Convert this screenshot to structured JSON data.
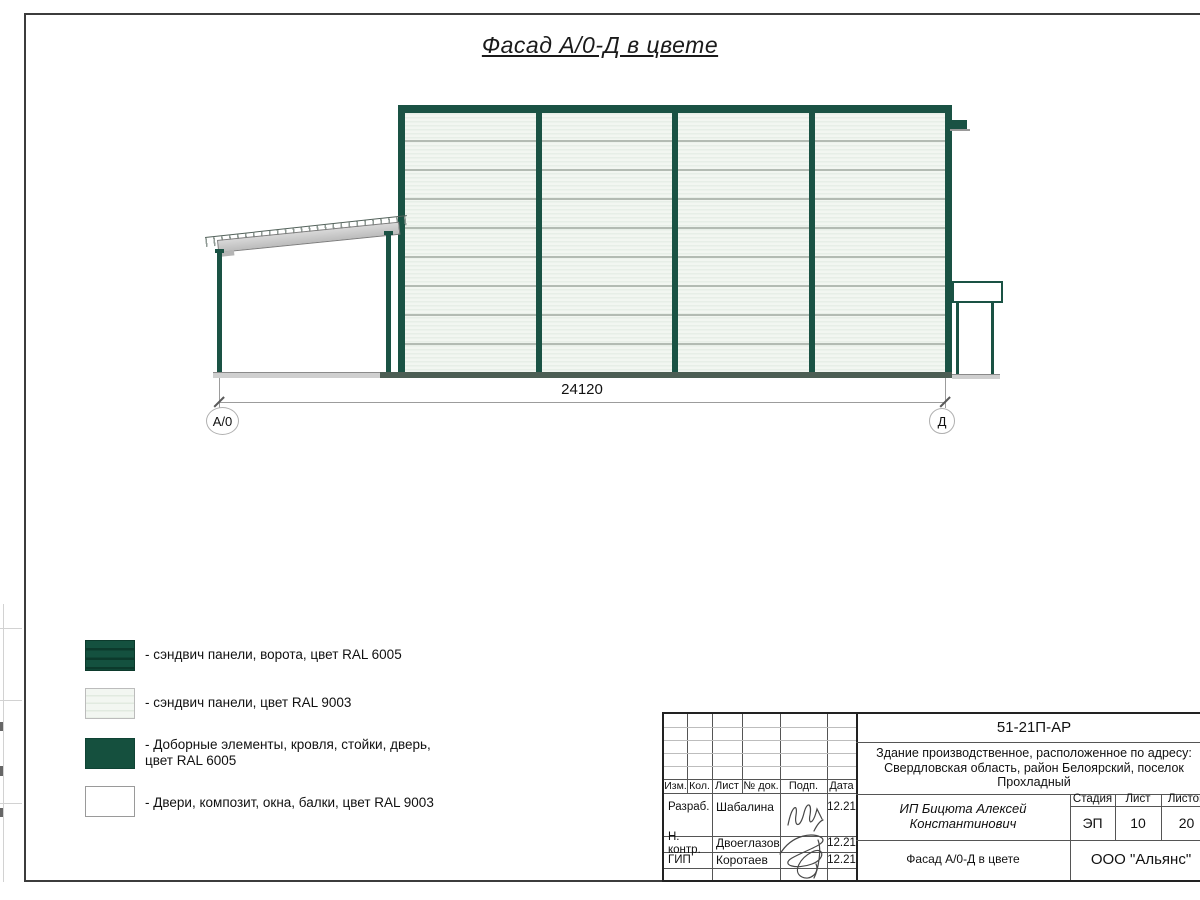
{
  "page": {
    "title": "Фасад А/0-Д в цвете"
  },
  "drawing": {
    "dimension_label": "24120",
    "axis_left_label": "А/0",
    "axis_right_label": "Д"
  },
  "legend": {
    "items": [
      {
        "swatch": "gate-sandwich-panels",
        "label": "- сэндвич панели, ворота, цвет RAL 6005"
      },
      {
        "swatch": "light-sandwich-panels",
        "label": "- сэндвич панели, цвет RAL 9003"
      },
      {
        "swatch": "trim-elements",
        "label": "- Доборные элементы, кровля, стойки, дверь,\nцвет RAL 6005"
      },
      {
        "swatch": "doors-windows",
        "label": "- Двери, композит, окна, балки, цвет RAL 9003"
      }
    ]
  },
  "title_block": {
    "doc_number": "51-21П-АР",
    "address": "Здание производственное, расположенное по адресу:\nСвердловская область, район Белоярский, поселок\nПрохладный",
    "col_izm": "Изм.",
    "col_kol": "Кол.",
    "col_list": "Лист",
    "col_ndoc": "№ док.",
    "col_podp": "Подп.",
    "col_data": "Дата",
    "rows": [
      {
        "role": "Разраб.",
        "name": "Шабалина",
        "date": "12.21"
      },
      {
        "role": "Н. контр.",
        "name": "Двоеглазов",
        "date": "12.21"
      },
      {
        "role": "ГИП",
        "name": "Коротаев",
        "date": "12.21"
      }
    ],
    "client": "ИП Бицюта Алексей\nКонстантинович",
    "stage_label": "Стадия",
    "sheet_label": "Лист",
    "sheets_label": "Листов",
    "stage_value": "ЭП",
    "sheet_value": "10",
    "sheets_value": "20",
    "sheet_title": "Фасад А/0-Д в цвете",
    "company": "ООО \"Альянс\""
  },
  "colors": {
    "ral6005_frame": "#1a5244",
    "ral9003_panel": "#f2f6f1",
    "panel_joint": "#b3bbb3",
    "beam_gray": "#c9c9c9"
  }
}
